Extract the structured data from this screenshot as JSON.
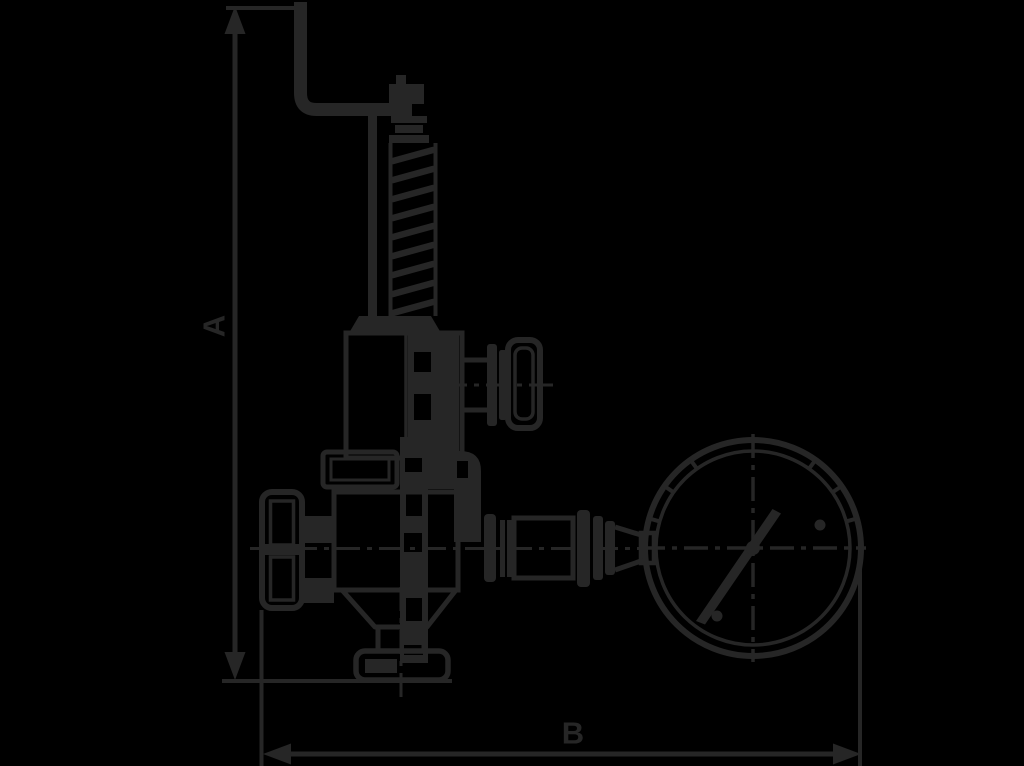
{
  "page": {
    "background_color": "#000000"
  },
  "diagram": {
    "ink_color": "#262626",
    "description": "Technical line drawing of a safety relief valve with top test lever, coil spring bonnet, side test knob, handwheel, bottom flange outlet and attached pressure gauge",
    "dimensions": {
      "height_label": "A",
      "width_label": "B"
    }
  }
}
